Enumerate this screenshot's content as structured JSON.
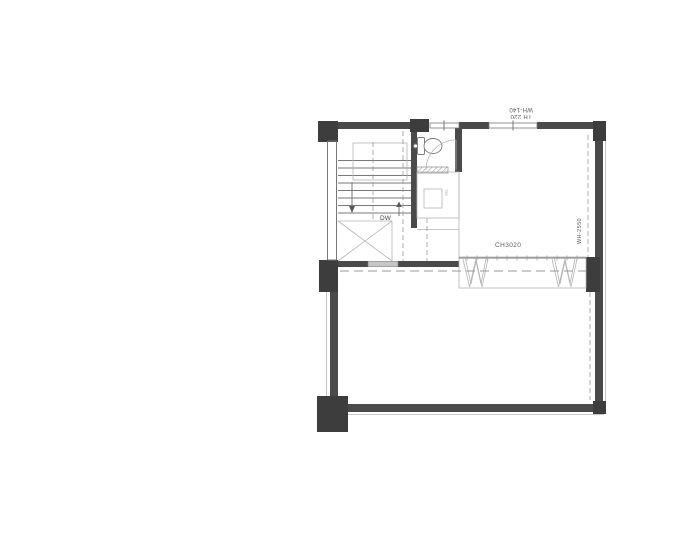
{
  "meta": {
    "document_type": "architectural-floor-plan",
    "canvas": {
      "width": 700,
      "height": 560
    }
  },
  "annotations": {
    "top_window": {
      "note": "window spec label drawn rotated 180deg on plan",
      "lines": [
        "TH 220",
        "WH-140"
      ],
      "readable_lines": [
        "WH-140",
        "TH 220"
      ]
    },
    "stair_label": "DW",
    "room_label": "CH3020",
    "right_window": {
      "text": "WH-2550",
      "note": "drawn vertically, rotated 180deg, along right wall"
    },
    "fixture_dim": "750"
  },
  "colors": {
    "background": "#ffffff",
    "wall": "#4a4a4a",
    "pillar": "#3d3d3d",
    "line": "#787878",
    "line_light": "#b5b5b5",
    "dash": "#9a9a9a",
    "glass": "#c6c6c6",
    "text": "#5a5a5a"
  }
}
